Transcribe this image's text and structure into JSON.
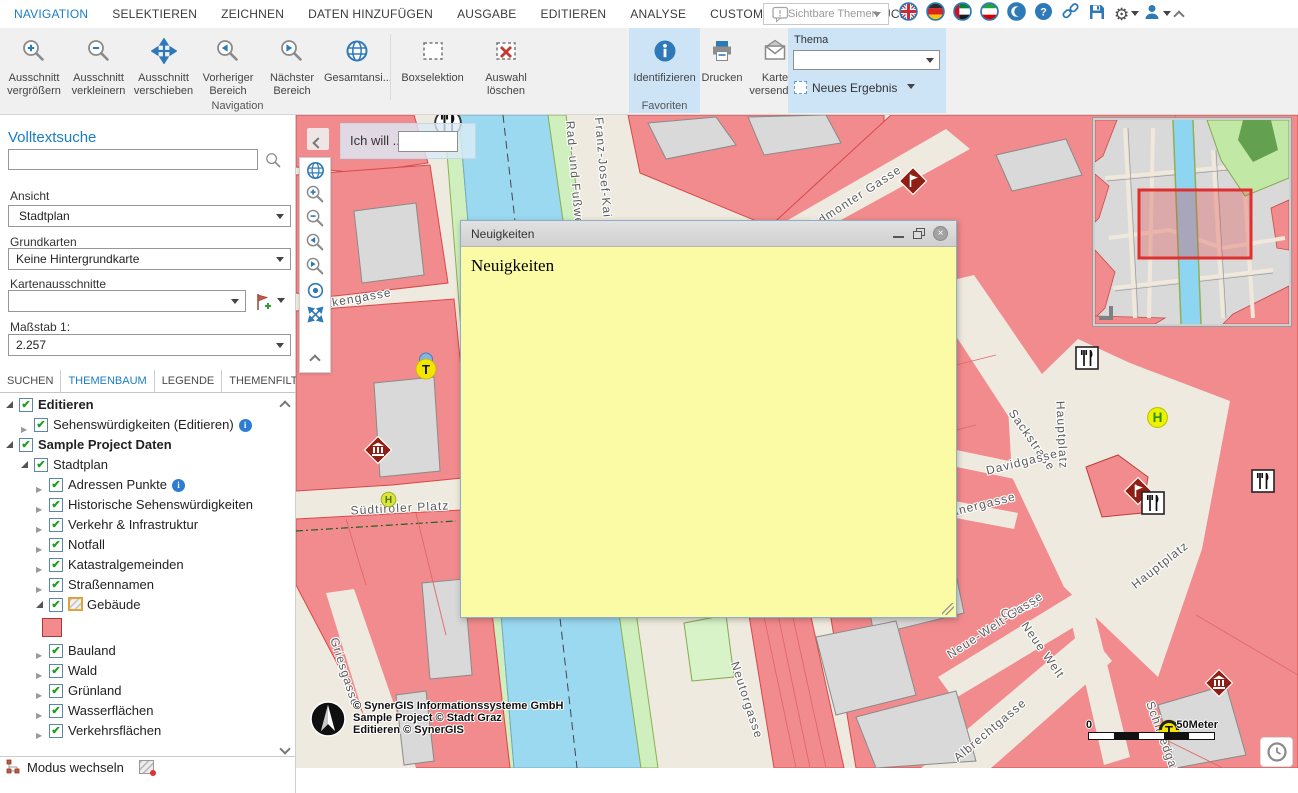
{
  "menubar": {
    "items": [
      {
        "label": "NAVIGATION",
        "active": true
      },
      {
        "label": "SELEKTIEREN",
        "active": false
      },
      {
        "label": "ZEICHNEN",
        "active": false
      },
      {
        "label": "DATEN HINZUFÜGEN",
        "active": false
      },
      {
        "label": "AUSGABE",
        "active": false
      },
      {
        "label": "EDITIEREN",
        "active": false
      },
      {
        "label": "ANALYSE",
        "active": false
      },
      {
        "label": "CUSTOM TOOLS",
        "active": false
      },
      {
        "label": "ESRI DRUCK",
        "active": false
      }
    ],
    "visible_themes_label": "Sichtbare Themen",
    "right_icons": [
      {
        "name": "flag-uk-icon"
      },
      {
        "name": "flag-germany-icon"
      },
      {
        "name": "flag-uae-icon"
      },
      {
        "name": "flag-iran-icon"
      },
      {
        "name": "flag-crescent-icon"
      },
      {
        "name": "help-icon"
      },
      {
        "name": "link-icon"
      },
      {
        "name": "save-icon"
      },
      {
        "name": "gear-icon",
        "caret": true
      },
      {
        "name": "user-icon",
        "caret": true
      },
      {
        "name": "collapse-up-icon"
      }
    ]
  },
  "ribbon": {
    "navigation_group_label": "Navigation",
    "favoriten_group_label": "Favoriten",
    "tools": [
      {
        "label": "Ausschnitt vergrößern",
        "icon": "zoomin"
      },
      {
        "label": "Ausschnitt verkleinern",
        "icon": "zoomout"
      },
      {
        "label": "Ausschnitt verschieben",
        "icon": "pan"
      },
      {
        "label": "Vorheriger Bereich",
        "icon": "prev"
      },
      {
        "label": "Nächster Bereich",
        "icon": "next"
      },
      {
        "label": "Gesamtansi...",
        "icon": "globe"
      },
      {
        "label": "Boxselektion",
        "icon": "boxsel"
      },
      {
        "label": "Auswahl löschen",
        "icon": "clearsel"
      },
      {
        "label": "Identifizieren",
        "icon": "identify",
        "highlight": true
      },
      {
        "label": "Drucken",
        "icon": "print"
      },
      {
        "label": "Karte versenden",
        "icon": "send"
      }
    ],
    "thema": {
      "label": "Thema",
      "value": "",
      "new_result_label": "Neues Ergebnis"
    }
  },
  "sidebar": {
    "fulltext_label": "Volltextsuche",
    "search_value": "",
    "ansicht_label": "Ansicht",
    "ansicht_value": "Stadtplan",
    "grundkarten_label": "Grundkarten",
    "grundkarten_value": "Keine Hintergrundkarte",
    "kartenausschnitte_label": "Kartenausschnitte",
    "kartenausschnitte_value": "",
    "massstab_label": "Maßstab 1:",
    "massstab_value": "2.257",
    "tabs": [
      {
        "label": "SUCHEN",
        "active": false
      },
      {
        "label": "THEMENBAUM",
        "active": true
      },
      {
        "label": "LEGENDE",
        "active": false
      },
      {
        "label": "THEMENFILTER",
        "active": false
      }
    ],
    "tree": [
      {
        "label": "Editieren",
        "level": 0,
        "state": "expanded",
        "checked": true,
        "bold": true
      },
      {
        "label": "Sehenswürdigkeiten (Editieren)",
        "level": 1,
        "state": "collapsed",
        "checked": true,
        "info": true
      },
      {
        "label": "Sample Project Daten",
        "level": 0,
        "state": "expanded",
        "checked": true,
        "bold": true
      },
      {
        "label": "Stadtplan",
        "level": 1,
        "state": "expanded",
        "checked": true
      },
      {
        "label": "Adressen Punkte",
        "level": 2,
        "state": "collapsed",
        "checked": true,
        "info": true
      },
      {
        "label": "Historische Sehenswürdigkeiten",
        "level": 2,
        "state": "collapsed",
        "checked": true
      },
      {
        "label": "Verkehr & Infrastruktur",
        "level": 2,
        "state": "collapsed",
        "checked": true
      },
      {
        "label": "Notfall",
        "level": 2,
        "state": "collapsed",
        "checked": true
      },
      {
        "label": "Katastralgemeinden",
        "level": 2,
        "state": "collapsed",
        "checked": true
      },
      {
        "label": "Straßennamen",
        "level": 2,
        "state": "collapsed",
        "checked": true
      },
      {
        "label": "Gebäude",
        "level": 2,
        "state": "expanded",
        "checked": true,
        "edit_icon": true
      },
      {
        "swatch": true,
        "level": 3
      },
      {
        "label": "Bauland",
        "level": 2,
        "state": "collapsed",
        "checked": true
      },
      {
        "label": "Wald",
        "level": 2,
        "state": "collapsed",
        "checked": true
      },
      {
        "label": "Grünland",
        "level": 2,
        "state": "collapsed",
        "checked": true
      },
      {
        "label": "Wasserflächen",
        "level": 2,
        "state": "collapsed",
        "checked": true
      },
      {
        "label": "Verkehrsflächen",
        "level": 2,
        "state": "collapsed",
        "checked": true
      }
    ],
    "modus_label": "Modus wechseln"
  },
  "map": {
    "ich_will_label": "Ich will ...",
    "ich_will_value": "",
    "street_labels": [
      {
        "text": "Rad- und Fußweg",
        "x": 279,
        "y": 62,
        "rot": 85
      },
      {
        "text": "-Franz-Josef-Kai",
        "x": 307,
        "y": 50,
        "rot": 85
      },
      {
        "text": "Admonter Gasse",
        "x": 560,
        "y": 82,
        "rot": -33
      },
      {
        "text": "Sackstraße",
        "x": 736,
        "y": 325,
        "rot": 55
      },
      {
        "text": "akengasse",
        "x": 62,
        "y": 183,
        "rot": -10
      },
      {
        "text": "Südtiroler Platz",
        "x": 104,
        "y": 393,
        "rot": -3
      },
      {
        "text": "Griesgasse",
        "x": 49,
        "y": 557,
        "rot": 72
      },
      {
        "text": "Hauptplatz",
        "x": 766,
        "y": 320,
        "rot": 87
      },
      {
        "text": "Hauptplatz",
        "x": 864,
        "y": 450,
        "rot": -38
      },
      {
        "text": "Davidgasse",
        "x": 726,
        "y": 347,
        "rot": -14
      },
      {
        "text": "kanergasse",
        "x": 684,
        "y": 390,
        "rot": -14
      },
      {
        "text": "Gasse",
        "x": 724,
        "y": 493,
        "rot": -20
      },
      {
        "text": "Neue-Welt-Gasse",
        "x": 699,
        "y": 510,
        "rot": -33
      },
      {
        "text": "Neue Welt",
        "x": 747,
        "y": 535,
        "rot": 55
      },
      {
        "text": "Albrechtgasse",
        "x": 694,
        "y": 615,
        "rot": -40
      },
      {
        "text": "Neutorgasse",
        "x": 451,
        "y": 585,
        "rot": 72
      },
      {
        "text": "Schmiedgas",
        "x": 867,
        "y": 623,
        "rot": 70
      }
    ],
    "pois": [
      {
        "type": "restaurant-circle",
        "x": 152,
        "y": 8
      },
      {
        "type": "diamond-flag",
        "x": 616,
        "y": 65
      },
      {
        "type": "diamond-museum",
        "x": 81,
        "y": 334
      },
      {
        "type": "tram-t",
        "x": 131,
        "y": 250
      },
      {
        "type": "hotel-h",
        "x": 98,
        "y": 390
      },
      {
        "type": "restaurant",
        "x": 793,
        "y": 245
      },
      {
        "type": "stop-h",
        "x": 864,
        "y": 305
      },
      {
        "type": "diamond-flag",
        "x": 841,
        "y": 375
      },
      {
        "type": "restaurant",
        "x": 859,
        "y": 390
      },
      {
        "type": "restaurant",
        "x": 969,
        "y": 368
      },
      {
        "type": "diamond-museum",
        "x": 922,
        "y": 567
      },
      {
        "type": "tram-t2",
        "x": 874,
        "y": 616
      }
    ],
    "copyright_lines": [
      "© SynerGIS Informationssysteme GmbH",
      "Sample Project © Stadt Graz",
      "Editieren © SynerGIS"
    ],
    "scale": {
      "start": "0",
      "end": "50Meter"
    }
  },
  "dialog": {
    "title": "Neuigkeiten",
    "body_text": "Neuigkeiten"
  },
  "colors": {
    "accent": "#1a7dc4",
    "ribbon_highlight": "#cde4f7",
    "building_pink": "#F28B8D",
    "building_stroke": "#D84848",
    "river_blue": "#9BD9F1",
    "street_beige": "#EFEADF",
    "dialog_yellow": "#FBFBA5",
    "extent_red": "#DF2F2F"
  }
}
